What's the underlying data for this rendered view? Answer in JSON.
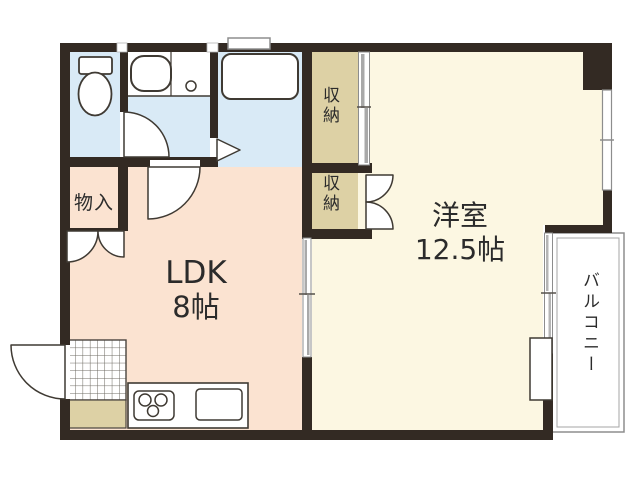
{
  "plan": {
    "type": "apartment-floor-plan",
    "rooms": {
      "ldk": {
        "name_line1": "LDK",
        "name_line2": "8帖"
      },
      "western_room": {
        "name_line1": "洋室",
        "name_line2": "12.5帖"
      },
      "balcony": {
        "name": "バルコニー"
      },
      "storage_upper": {
        "name": "収納"
      },
      "storage_lower": {
        "name": "収納"
      },
      "closet": {
        "name": "物入"
      }
    },
    "colors": {
      "wall": "#332a23",
      "wet_area_floor": "#d9eaf6",
      "storage_floor": "#ddd1a5",
      "ldk_floor": "#fbe3d1",
      "western_room_floor": "#fcf7e2",
      "balcony_floor": "#ffffff",
      "fixture_outline": "#3f3a33",
      "window_gray": "#8d8d8d",
      "text": "#2b2b2b"
    }
  }
}
